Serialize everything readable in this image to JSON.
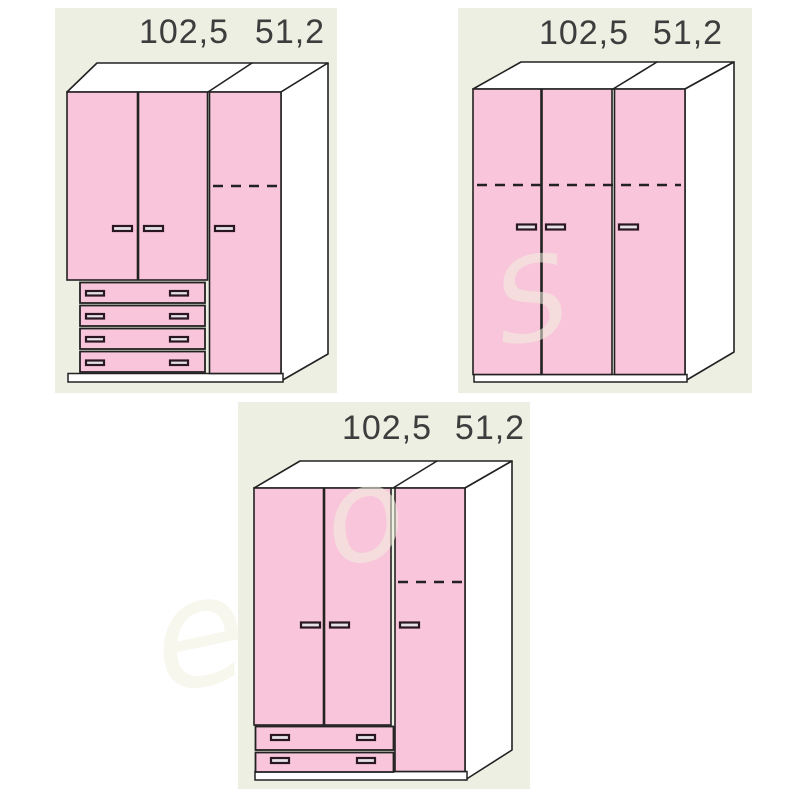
{
  "colors": {
    "panel_bg": "#edefe2",
    "door_pink": "#f8c5da",
    "outline": "#222222",
    "dim_text": "#3d3d3d",
    "handle_dark": "#2b1722",
    "face_white": "#ffffff",
    "watermark": "#f2f0e0"
  },
  "watermark": {
    "letters": [
      "e",
      "o",
      "S"
    ]
  },
  "panels": [
    {
      "name": "top-left",
      "width_label": "102,5",
      "depth_label": "51,2",
      "wardrobe": {
        "doors": 3,
        "drawers": 4,
        "dashed_shelf": "right-door"
      }
    },
    {
      "name": "top-right",
      "width_label": "102,5",
      "depth_label": "51,2",
      "wardrobe": {
        "doors": 3,
        "drawers": 0,
        "dashed_shelf": "all-doors"
      }
    },
    {
      "name": "bottom-center",
      "width_label": "102,5",
      "depth_label": "51,2",
      "wardrobe": {
        "doors": 3,
        "drawers": 2,
        "dashed_shelf": "right-door"
      }
    }
  ]
}
